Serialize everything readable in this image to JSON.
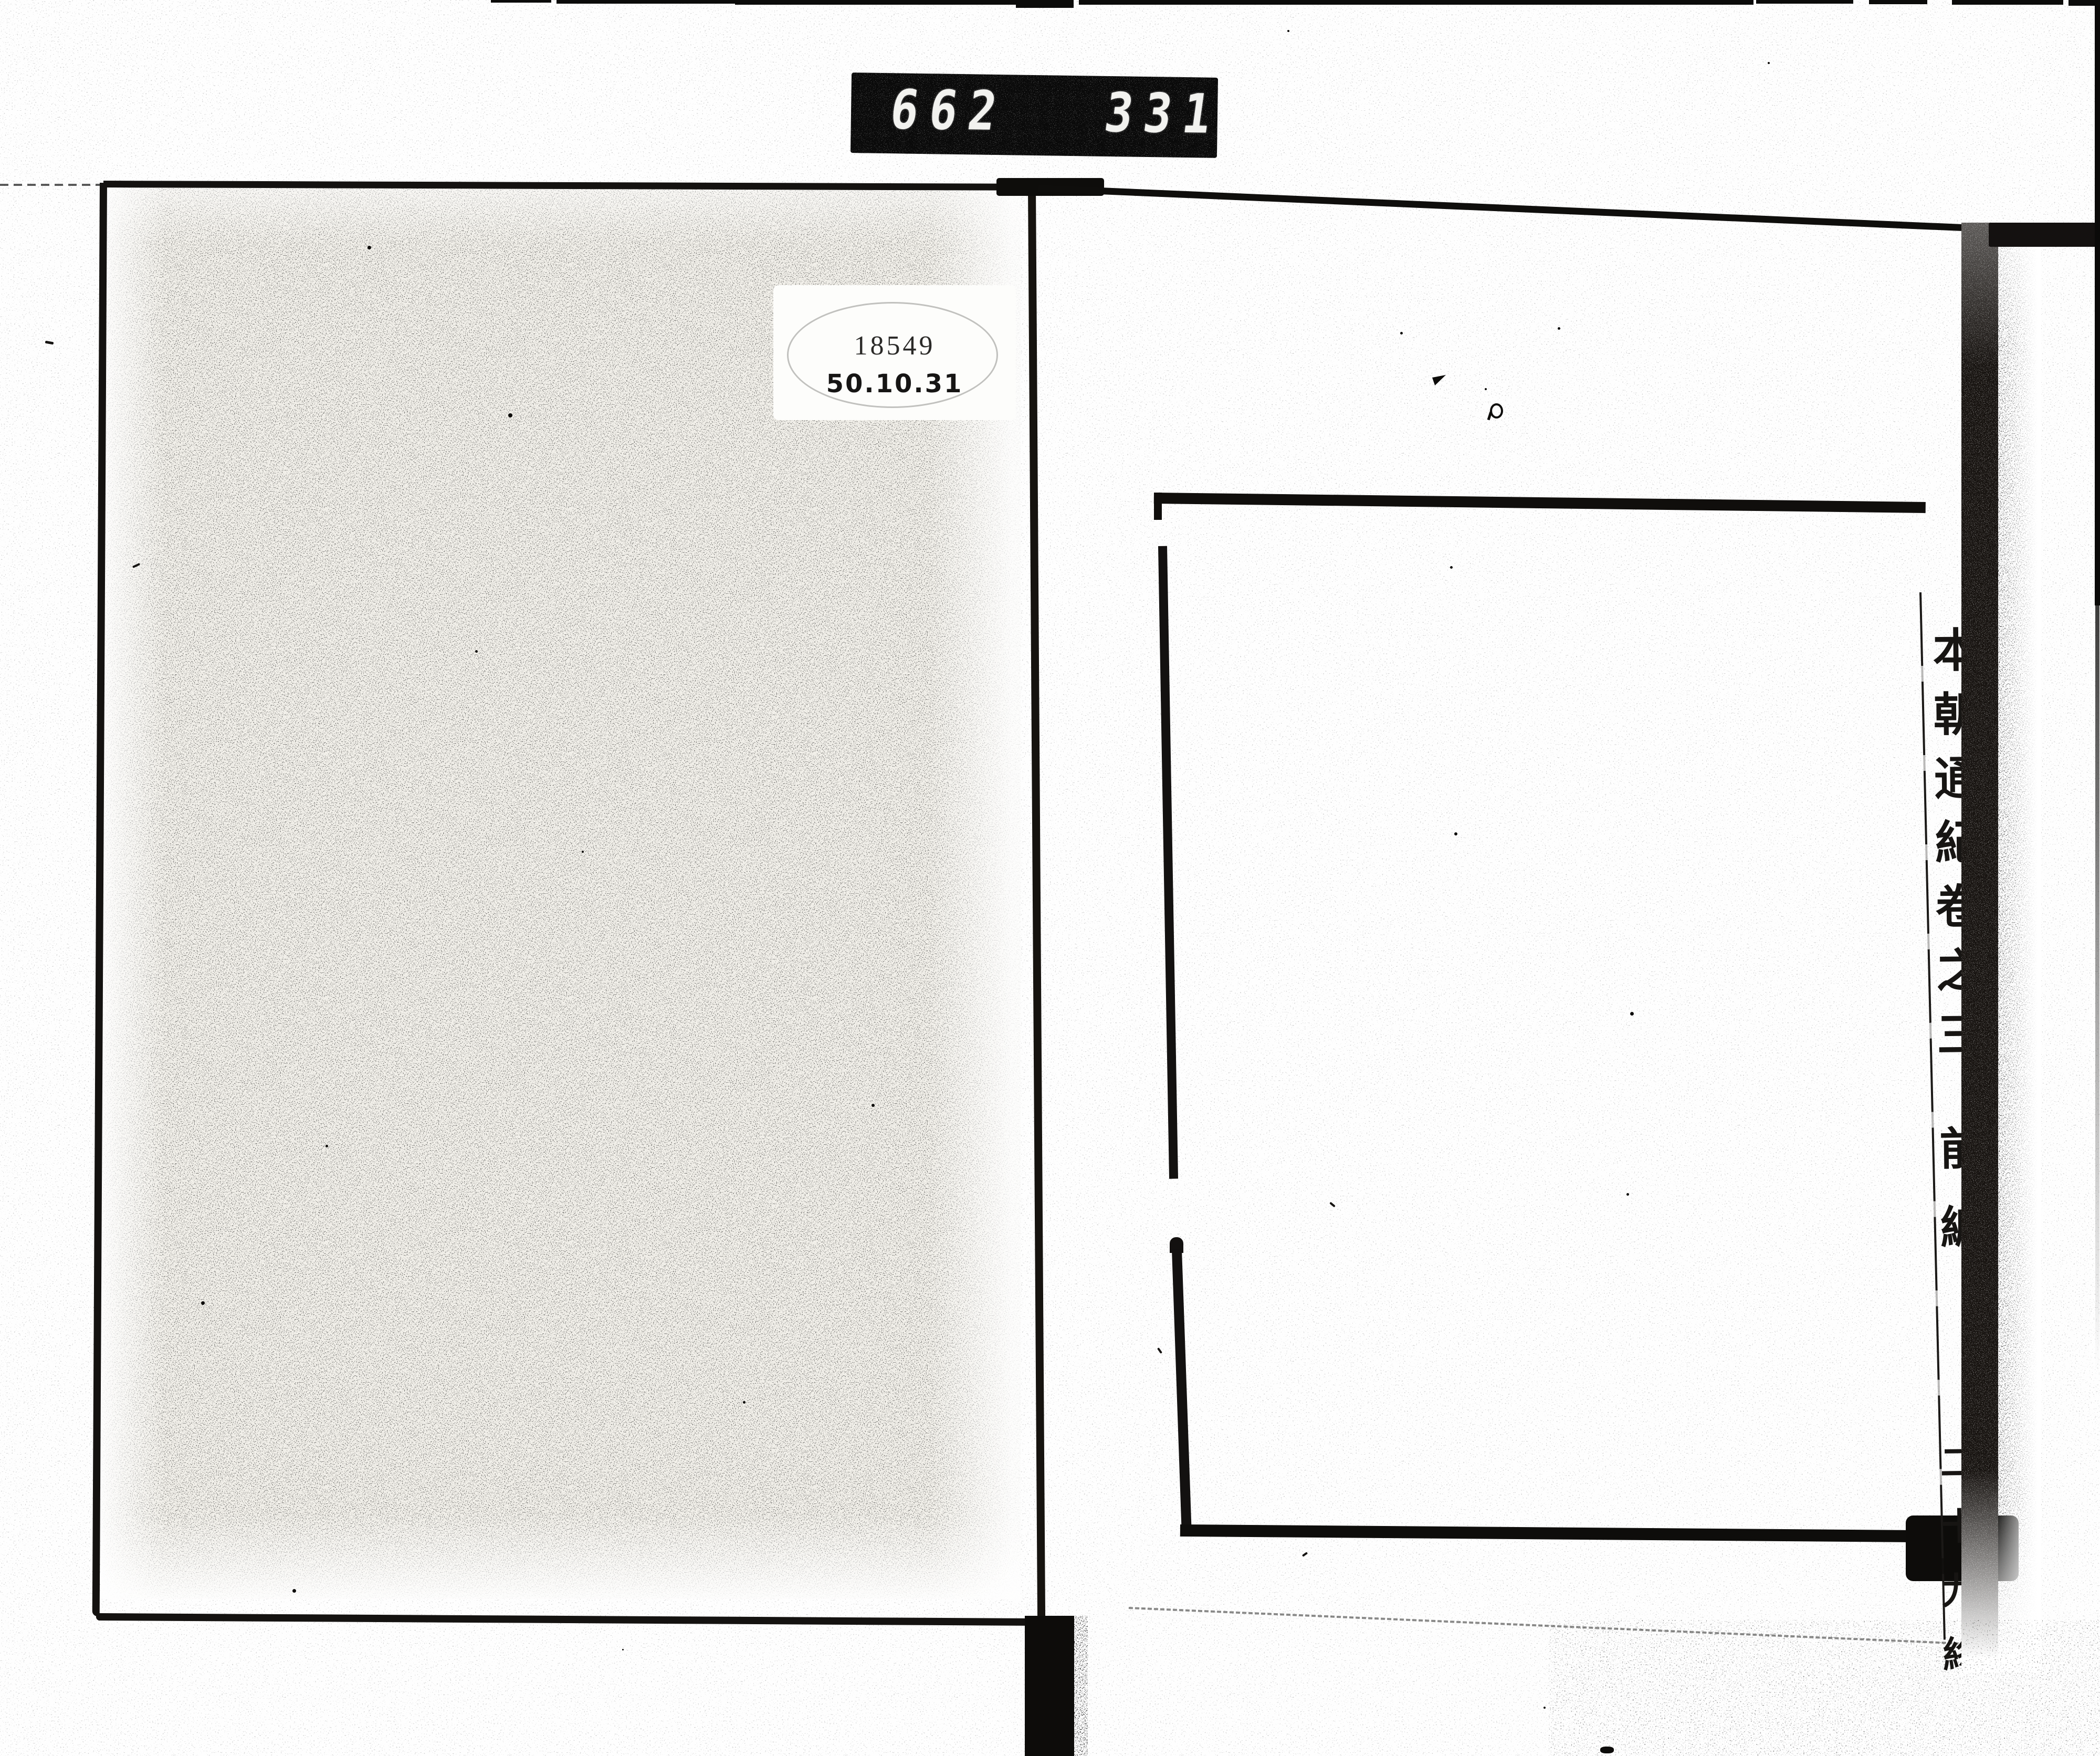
{
  "counter": {
    "left_digits": "662",
    "right_digits": "331."
  },
  "label": {
    "accession_number": "18549",
    "date_code": "50.10.31"
  },
  "spine": {
    "title": "本朝通紀卷之三",
    "section": "前編",
    "volume": "二十九終"
  },
  "colors": {
    "ink": "#0d0c0a",
    "paper": "#ffffff",
    "cover_paper": "#f2f0ea",
    "counter_bg": "#0a0a0a",
    "counter_digit": "#f2f2ef"
  }
}
